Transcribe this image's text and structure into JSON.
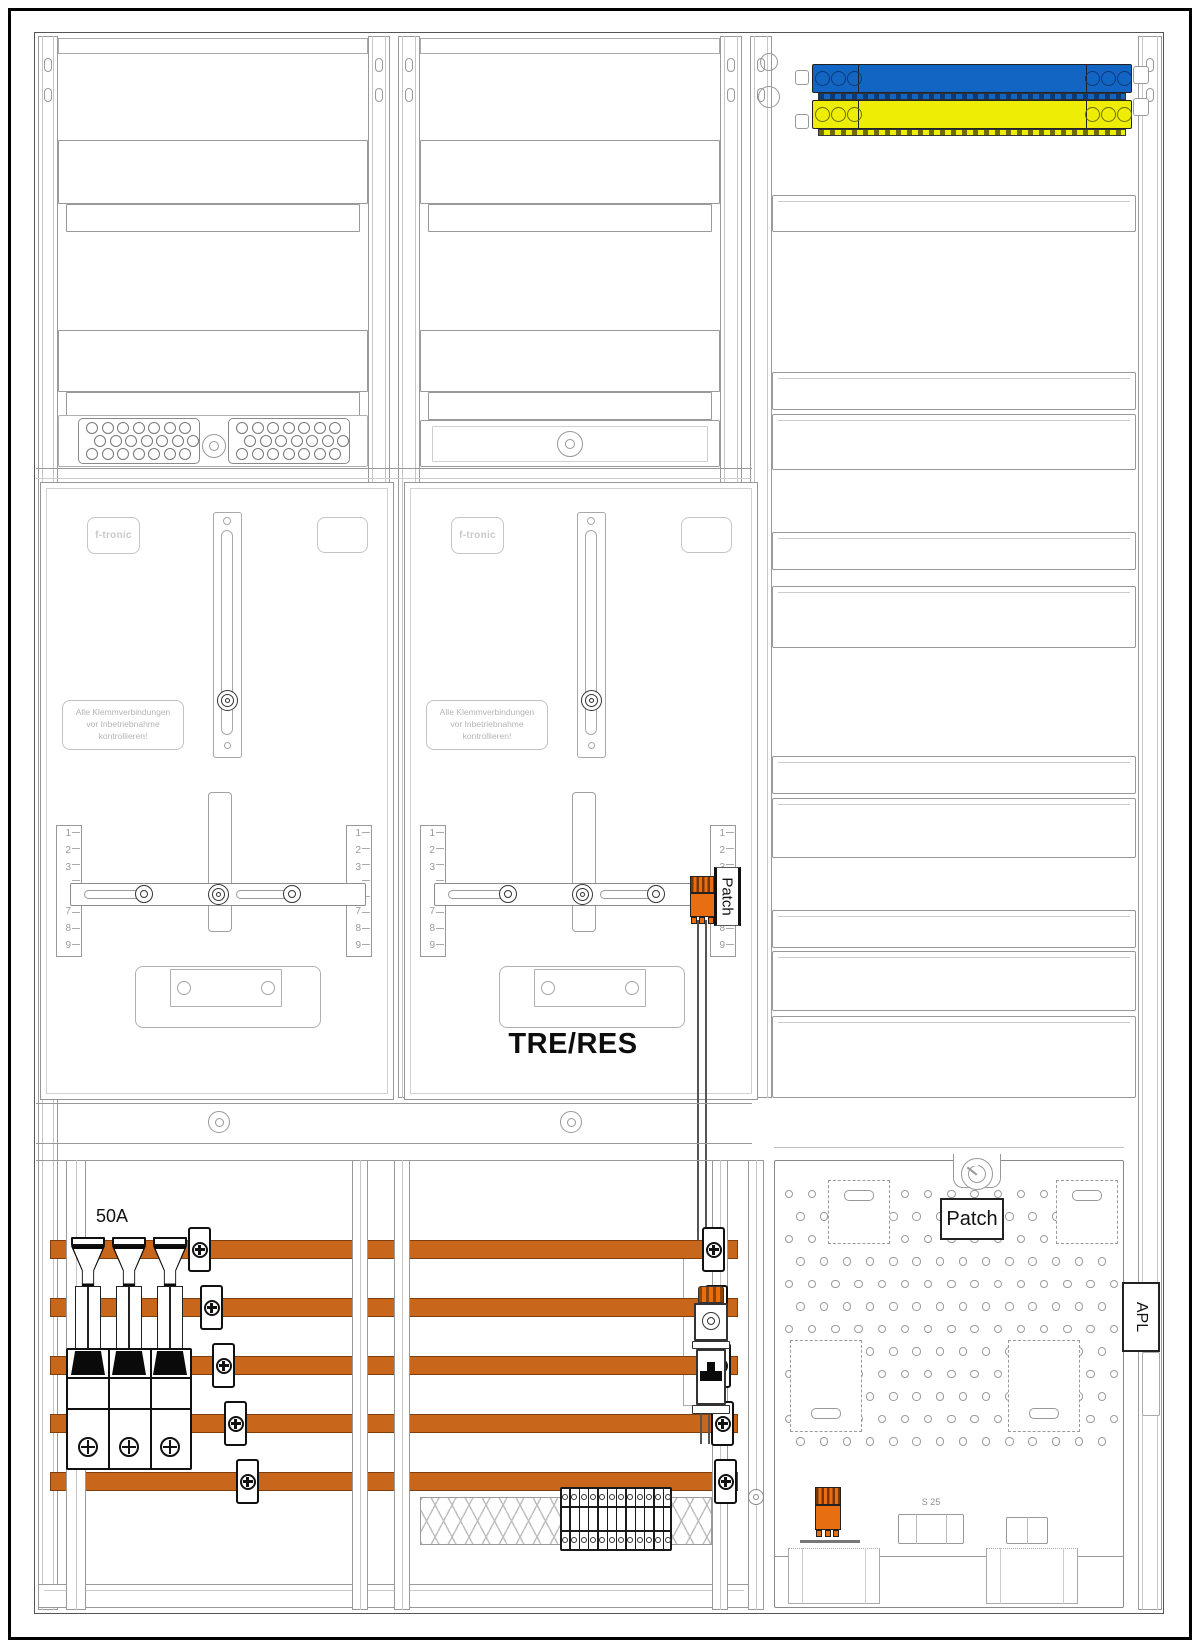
{
  "colors": {
    "busbar": "#C8671C",
    "busbar_border": "#7E3E0E",
    "component_orange": "#E86E12",
    "blue_bar": "#1365C4",
    "blue_bar_dark": "#0A3A74",
    "yellow_bar": "#EDED05",
    "yellow_bar_dark": "#6E6E00",
    "line_light": "#9A9A9A",
    "line_dark": "#1A1A1A"
  },
  "meter": {
    "brand": "f-tronic",
    "warning_lines": [
      "Alle Klemmverbindungen",
      "vor Inbetriebnahme",
      "kontrollieren!"
    ],
    "ruler_numbers_top": [
      "1",
      "2",
      "3"
    ],
    "ruler_numbers_bottom": [
      "7",
      "8",
      "9"
    ]
  },
  "labels": {
    "middle_field": "TRE/RES",
    "meter_patch": "Patch",
    "apz_patch": "Patch",
    "breaker_rating": "50A",
    "apl": "APL",
    "pipe_size": "S 25"
  }
}
